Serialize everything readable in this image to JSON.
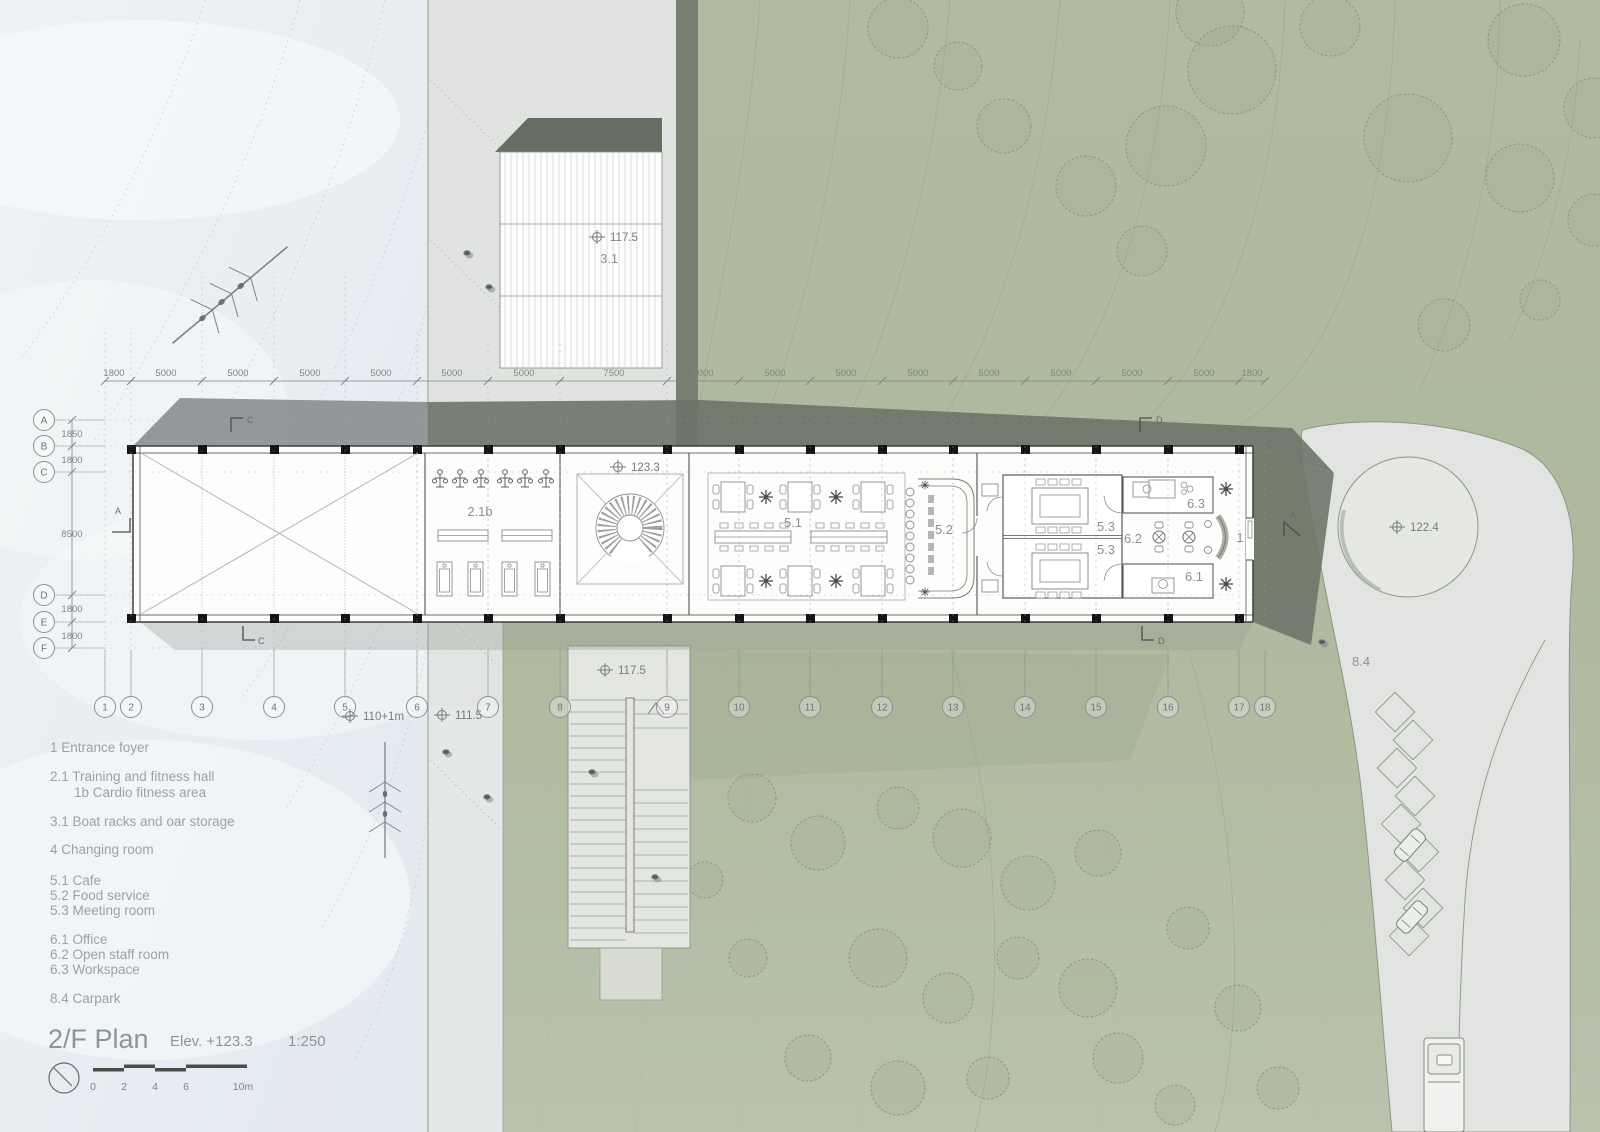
{
  "title": {
    "name": "2/F Plan",
    "elev": "Elev. +123.3",
    "scale": "1:250"
  },
  "scalebar": {
    "ticks": [
      "0",
      "2",
      "4",
      "6",
      "10m"
    ]
  },
  "legend": {
    "items": [
      "1 Entrance foyer",
      "2.1 Training and fitness hall",
      "1b Cardio fitness area",
      "3.1 Boat racks and oar storage",
      "4 Changing room",
      "5.1 Cafe",
      "5.2 Food service",
      "5.3 Meeting room",
      "6.1 Office",
      "6.2 Open staff room",
      "6.3 Workspace",
      "8.4 Carpark"
    ]
  },
  "grid": {
    "cols": [
      "1",
      "2",
      "3",
      "4",
      "5",
      "6",
      "7",
      "8",
      "9",
      "10",
      "11",
      "12",
      "13",
      "14",
      "15",
      "16",
      "17",
      "18"
    ],
    "rows": [
      "A",
      "B",
      "C",
      "D",
      "E",
      "F"
    ],
    "top_dims": [
      "1800",
      "5000",
      "5000",
      "5000",
      "5000",
      "5000",
      "5000",
      "7500",
      "5000",
      "5000",
      "5000",
      "5000",
      "5000",
      "5000",
      "5000",
      "5000",
      "1800"
    ],
    "left_dims": [
      "1850",
      "1800",
      "8500",
      "1800",
      "1800"
    ]
  },
  "levels": {
    "boat_store": "117.5",
    "main_floor": "123.3",
    "stair_landing": "117.5",
    "water": "110+1m",
    "ramp": "111.5",
    "road": "122.4"
  },
  "rooms": {
    "fitness": "2.1b",
    "boat_store": "3.1",
    "cafe": "5.1",
    "food_service": "5.2",
    "meeting": "5.3",
    "office": "6.1",
    "staff": "6.2",
    "workspace": "6.3",
    "foyer": "1",
    "carpark": "8.4"
  },
  "sections": {
    "c": "C",
    "d": "D",
    "a": "A"
  },
  "colors": {
    "water": "#e9eef3",
    "terrain": "#b2bda4",
    "roof_shadow": "#6d7368",
    "pavement": "#e2e4e1",
    "accent_line": "#8d9489"
  }
}
